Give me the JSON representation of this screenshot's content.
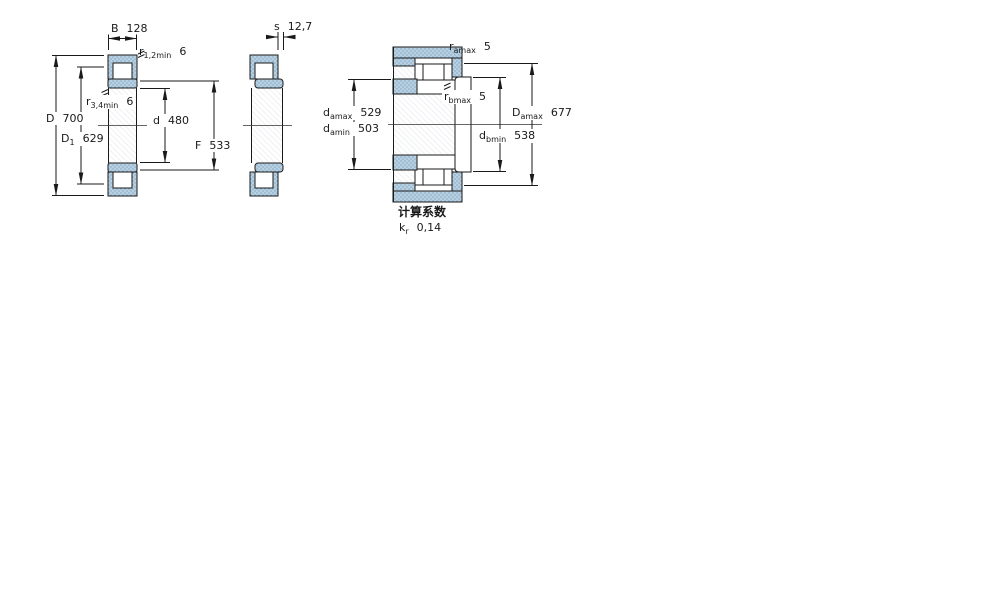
{
  "drawing": {
    "title": "cylindrical-roller-bearing-dimension-drawing",
    "colors": {
      "ring_fill": "#b8d0e2",
      "ring_dot": "#86abc6",
      "line": "#1a1a1a",
      "background": "#ffffff"
    }
  },
  "labels": {
    "B": {
      "base": "B",
      "sub": "",
      "value": "128"
    },
    "r12": {
      "base": "r",
      "sub": "1,2min",
      "value": "6"
    },
    "r34": {
      "base": "r",
      "sub": "3,4min",
      "value": "6"
    },
    "D": {
      "base": "D",
      "sub": "",
      "value": "700"
    },
    "D1": {
      "base": "D",
      "sub": "1",
      "value": "629"
    },
    "d": {
      "base": "d",
      "sub": "",
      "value": "480"
    },
    "F": {
      "base": "F",
      "sub": "",
      "value": "533"
    },
    "s": {
      "base": "s",
      "sub": "",
      "value": "12,7"
    },
    "ramax": {
      "base": "r",
      "sub": "amax",
      "value": "5"
    },
    "rbmax": {
      "base": "r",
      "sub": "bmax",
      "value": "5"
    },
    "damax": {
      "base": "d",
      "sub": "amax",
      "value": "529"
    },
    "damin": {
      "base": "d",
      "sub": "amin",
      "value": "503"
    },
    "dbmin": {
      "base": "d",
      "sub": "bmin",
      "value": "538"
    },
    "Damax": {
      "base": "D",
      "sub": "amax",
      "value": "677"
    },
    "calc_heading": "计算系数",
    "kr": {
      "base": "k",
      "sub": "r",
      "value": "0,14"
    }
  }
}
